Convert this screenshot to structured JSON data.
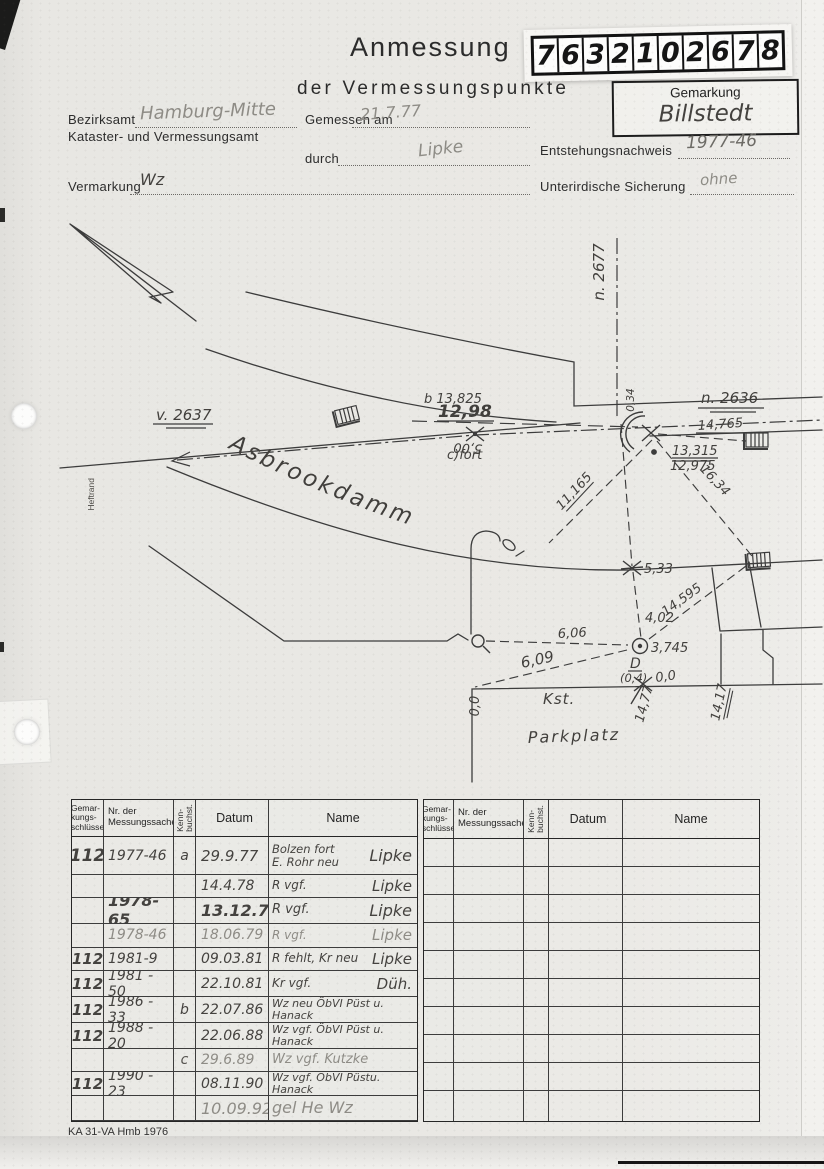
{
  "colors": {
    "paper": "#e8e7e3",
    "ink": "#2f2f2f",
    "pen": "#413f3c",
    "pencil": "#8e8c86"
  },
  "header": {
    "title": "Anmessung",
    "subtitle": "der Vermessungspunkte",
    "digits": [
      "7",
      "6",
      "3",
      "2",
      "1",
      "0",
      "2",
      "6",
      "7",
      "8"
    ],
    "gemarkung_label": "Gemarkung",
    "gemarkung_value": "Billstedt"
  },
  "form": {
    "bezirksamt_label": "Bezirksamt",
    "bezirksamt_value": "Hamburg-Mitte",
    "amt_line": "Kataster- und Vermessungsamt",
    "gemessen_label": "Gemessen am",
    "gemessen_value": "21.7.77",
    "durch_label": "durch",
    "durch_value": "Lipke",
    "entstehung_label": "Entstehungsnachweis",
    "entstehung_value": "1977-46",
    "vermarkung_label": "Vermarkung",
    "vermarkung_value": "Wz",
    "sicherung_label": "Unterirdische Sicherung",
    "sicherung_value": "ohne"
  },
  "margin_label": "Heftrand",
  "sketch": {
    "labels": {
      "v2637": "v. 2637",
      "n2677": "n. 2677",
      "n2636": "n. 2636",
      "street": "Asbrookdamm",
      "b13825": "b 13,825",
      "m1298": "12,98",
      "cfort": "c)fort",
      "m500": "5,00",
      "m034": "0,34",
      "m13315": "13,315",
      "m12975": "12,975",
      "m14765": "14,765",
      "m1634": "16,34",
      "m11165": "11,165",
      "m533": "5,33",
      "m14595": "14,595",
      "m402": "4,02",
      "m606": "6,06",
      "m3745": "3,745",
      "pointD": "D",
      "pointD_off": "(0,4)",
      "m609": "6,09",
      "m00r": "0,0",
      "m1477": "14,77",
      "kst": "Kst.",
      "m1417": "14,17",
      "m00l": "0,0",
      "parkplatz": "Parkplatz"
    }
  },
  "table": {
    "headers": {
      "c1": "Gemar-\nkungs-\nschlüssel",
      "c2": "Nr. der\nMessungssache",
      "c3": "Kenn-\nbuchst.",
      "c4": "Datum",
      "c5": "Name"
    },
    "rows": [
      {
        "g": "112",
        "nr": "1977-46",
        "kb": "a",
        "datum": "29.9.77",
        "action": "Bolzen fort\nE. Rohr neu",
        "who": "Lipke"
      },
      {
        "g": "",
        "nr": "",
        "kb": "",
        "datum": "14.4.78",
        "action": "R vgf.",
        "who": "Lipke"
      },
      {
        "g": "",
        "nr": "1978-65",
        "kb": "",
        "datum": "13.12.78",
        "action": "R vgf.",
        "who": "Lipke"
      },
      {
        "g": "",
        "nr": "1978-46",
        "kb": "",
        "datum": "18.06.79",
        "action": "R vgf.",
        "who": "Lipke"
      },
      {
        "g": "112",
        "nr": "1981-9",
        "kb": "",
        "datum": "09.03.81",
        "action": "R fehlt, Kr neu",
        "who": "Lipke"
      },
      {
        "g": "112",
        "nr": "1981 - 50",
        "kb": "",
        "datum": "22.10.81",
        "action": "Kr vgf.",
        "who": "Düh."
      },
      {
        "g": "112",
        "nr": "1986 - 33",
        "kb": "b",
        "datum": "22.07.86",
        "action": "Wz neu ÖbVI Püst u. Hanack",
        "who": ""
      },
      {
        "g": "112",
        "nr": "1988 - 20",
        "kb": "",
        "datum": "22.06.88",
        "action": "Wz vgf. ÖbVI Püst u. Hanack",
        "who": ""
      },
      {
        "g": "",
        "nr": "",
        "kb": "c",
        "datum": "29.6.89",
        "action": "Wz vgf. Kutzke",
        "who": ""
      },
      {
        "g": "112",
        "nr": "1990 - 23",
        "kb": "",
        "datum": "08.11.90",
        "action": "Wz vgf. ÖbVI Püstu. Hanack",
        "who": ""
      },
      {
        "g": "",
        "nr": "",
        "kb": "",
        "datum": "10.09.92",
        "action": "gel He Wz",
        "who": ""
      },
      {
        "g": "",
        "nr": "",
        "kb": "",
        "datum": "",
        "action": "",
        "who": ""
      }
    ]
  },
  "footer": "KA 31-VA Hmb 1976"
}
